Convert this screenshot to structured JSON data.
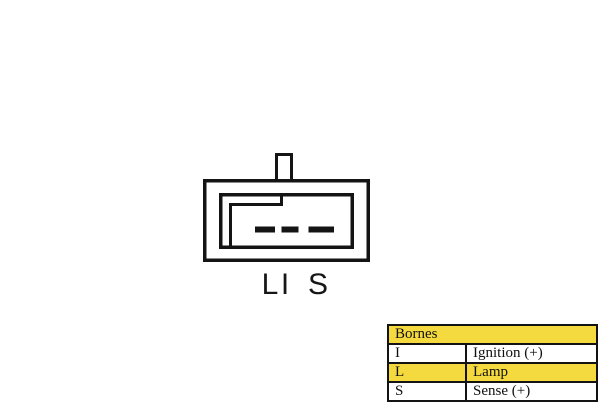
{
  "diagram": {
    "type": "connector-pinout",
    "pin_count": 3,
    "pin_labels": [
      "L",
      "I",
      "S"
    ],
    "line_color": "#141414",
    "fill_color": "#ffffff"
  },
  "table": {
    "header": "Bornes",
    "rows": [
      {
        "terminal": "I",
        "description": "Ignition (+)",
        "highlighted": false
      },
      {
        "terminal": "L",
        "description": "Lamp",
        "highlighted": true
      },
      {
        "terminal": "S",
        "description": "Sense (+)",
        "highlighted": false
      }
    ],
    "highlight_color": "#f4da3e",
    "border_color": "#131313",
    "text_color": "#101010"
  }
}
